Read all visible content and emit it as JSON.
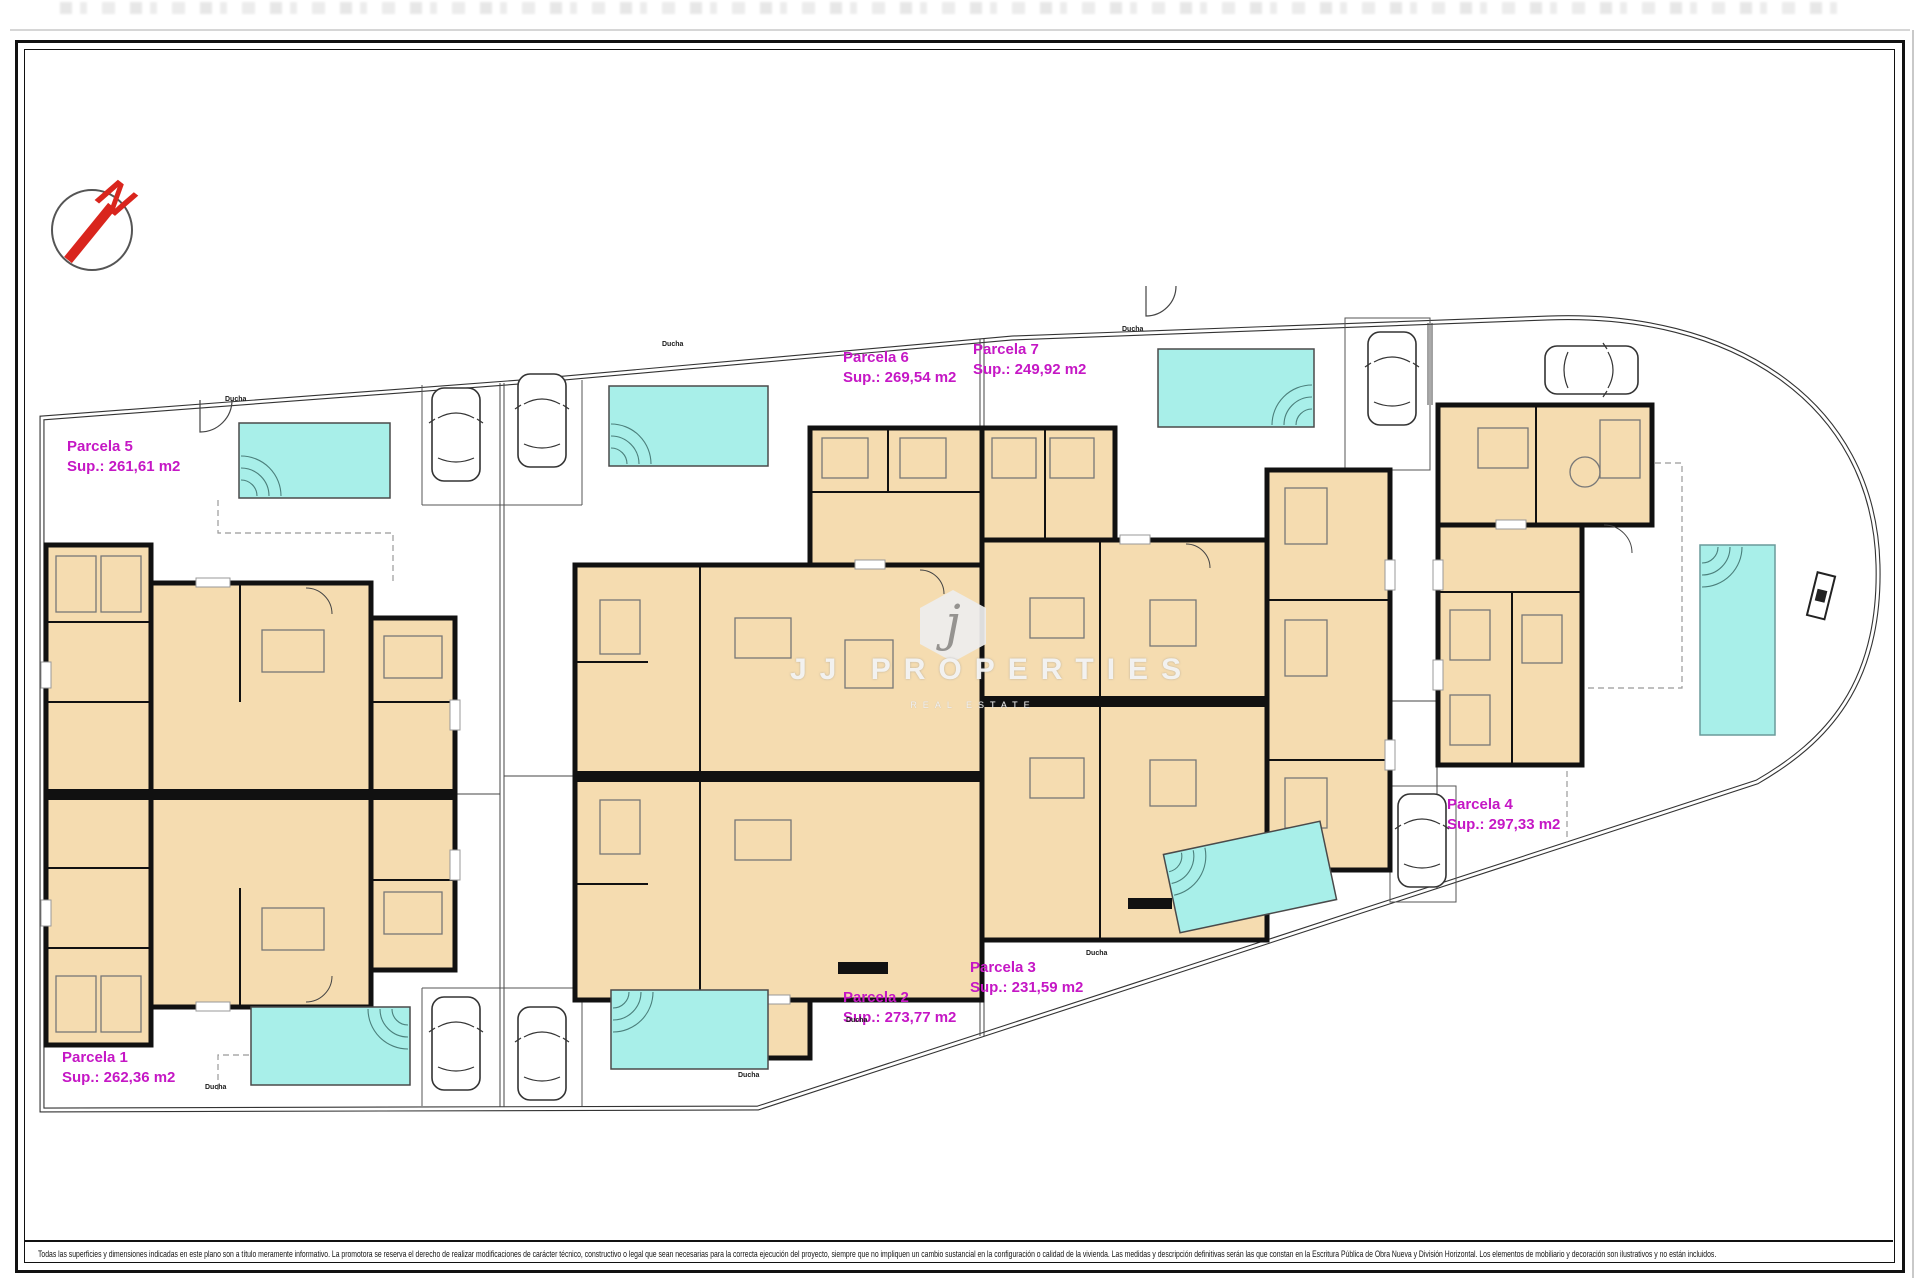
{
  "north_arrow": {
    "label": "N"
  },
  "watermark": {
    "monogram": "j",
    "title": "JJ PROPERTIES",
    "subtitle": "REAL ESTATE"
  },
  "labels": {
    "shower": "Ducha"
  },
  "parcels": [
    {
      "name": "Parcela 1",
      "area": "Sup.: 262,36 m2"
    },
    {
      "name": "Parcela 2",
      "area": "Sup.: 273,77 m2"
    },
    {
      "name": "Parcela 3",
      "area": "Sup.: 231,59 m2"
    },
    {
      "name": "Parcela 4",
      "area": "Sup.: 297,33 m2"
    },
    {
      "name": "Parcela 5",
      "area": "Sup.: 261,61 m2"
    },
    {
      "name": "Parcela 6",
      "area": "Sup.: 269,54 m2"
    },
    {
      "name": "Parcela 7",
      "area": "Sup.: 249,92 m2"
    }
  ],
  "disclaimer": "Todas las superficies y dimensiones indicadas en este plano son a título meramente informativo. La promotora se reserva el derecho de realizar modificaciones de carácter técnico, constructivo o legal que sean necesarias para la correcta ejecución del proyecto, siempre que no impliquen un cambio sustancial en la configuración o calidad de la vivienda. Las medidas y descripción definitivas serán las que constan en la Escritura Pública de Obra Nueva y División Horizontal. Los elementos de mobiliario y decoración son ilustrativos y no están incluidos.",
  "colors": {
    "accent_magenta": "#c517c5",
    "pool_cyan": "#a8efe9",
    "building_tan": "#f5dcb0",
    "wall_black": "#111111",
    "arrow_red": "#d9251d"
  }
}
